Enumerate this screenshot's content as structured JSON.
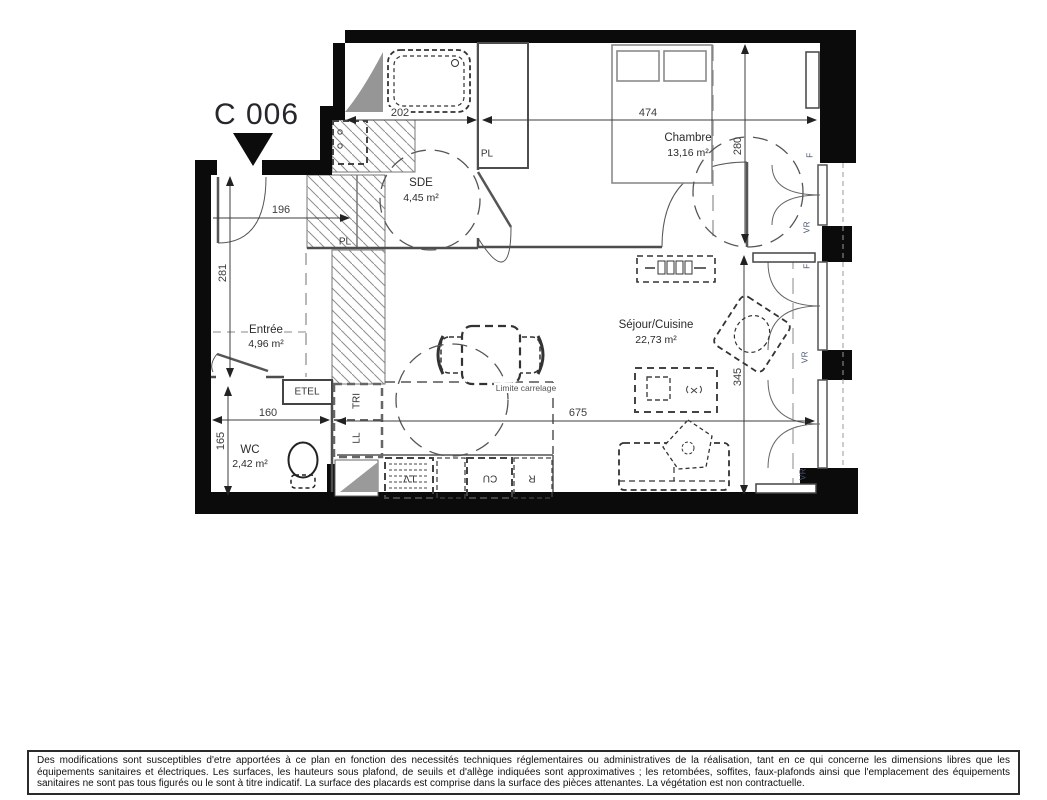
{
  "title": "C 006",
  "rooms": {
    "chambre": {
      "name": "Chambre",
      "area": "13,16 m²"
    },
    "sde": {
      "name": "SDE",
      "area": "4,45 m²"
    },
    "entree": {
      "name": "Entrée",
      "area": "4,96 m²"
    },
    "wc": {
      "name": "WC",
      "area": "2,42 m²"
    },
    "sejour": {
      "name": "Séjour/Cuisine",
      "area": "22,73 m²"
    }
  },
  "dimensions_cm": {
    "sde_width": "202",
    "chambre_width": "474",
    "chambre_depth": "280",
    "entree_width": "196",
    "entree_depth": "281",
    "wc_width": "160",
    "wc_depth": "165",
    "sejour_width": "675",
    "sejour_depth": "345"
  },
  "fixtures": {
    "closet_entree": "PL",
    "closet_chambre": "PL",
    "electrical_panel": "ETEL",
    "waste_sorting": "TRI",
    "washing_machine": "LL",
    "dishwasher": "LV",
    "cooktop": "CU",
    "fridge": "R",
    "tile_limit": "Limite carrelage"
  },
  "windows": {
    "w1_f": "F",
    "w1_vr": "VR",
    "w2_f": "F",
    "w2_vr": "VR",
    "w3_vr": "VR"
  },
  "colors": {
    "wall": "#0b0b0b",
    "title_text": "#26262c",
    "dim_text": "#3c3c3c",
    "window_label": "#46536e"
  },
  "disclaimer": "Des modifications sont susceptibles d'etre apportées à ce plan en fonction des necessités techniques réglementaires ou administratives de la réalisation, tant en ce qui concerne les dimensions libres que les équipements sanitaires et électriques. Les surfaces, les hauteurs sous plafond, de seuils et d'allège indiquées sont approximatives ; les retombées, soffites, faux-plafonds ainsi que l'emplacement des équipements sanitaires ne sont pas tous figurés ou le sont à titre indicatif. La surface des placards est comprise dans la surface des pièces attenantes. La végétation est non contractuelle."
}
